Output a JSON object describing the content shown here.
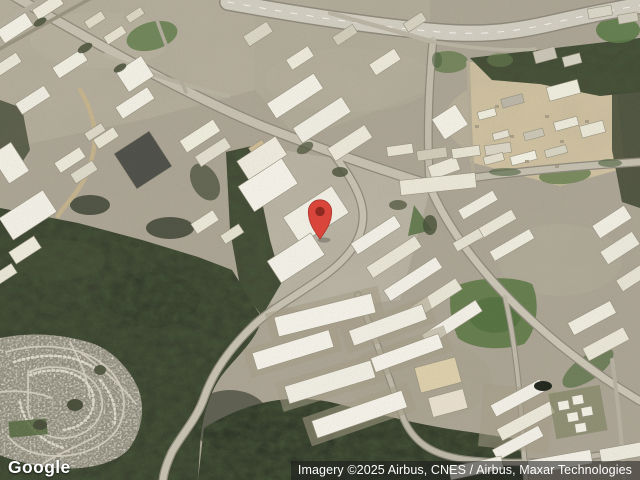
{
  "map": {
    "view_type": "satellite",
    "marker": {
      "name": "red-location-pin",
      "color": "#D9453A",
      "stroke_color": "#A8352A",
      "dot_color": "#8E2A21"
    }
  },
  "branding": {
    "logo_text": "Google"
  },
  "attribution": {
    "text": "Imagery ©2025 Airbus, CNES / Airbus, Maxar Technologies"
  }
}
